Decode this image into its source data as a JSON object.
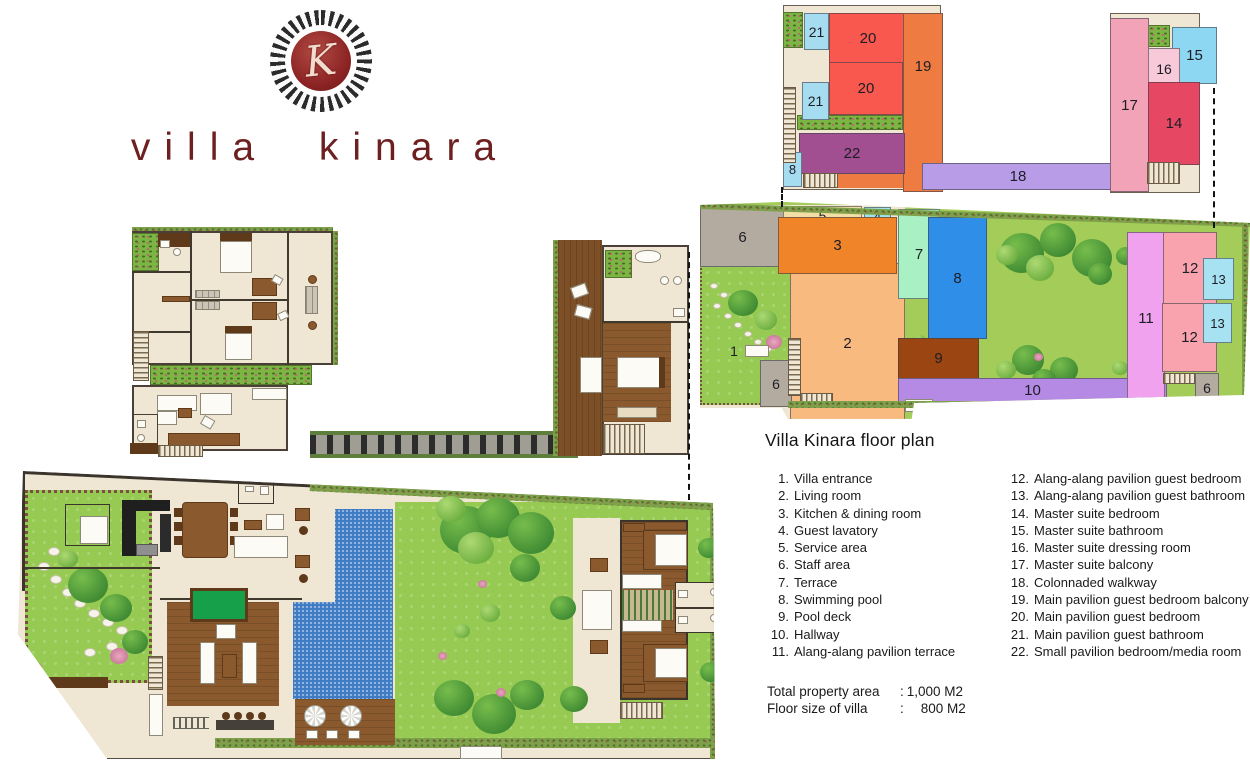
{
  "brand": {
    "wordmark": "villa kinara",
    "monogram": "K"
  },
  "panel": {
    "title": "Villa Kinara floor plan",
    "legend_left": [
      {
        "num": "1.",
        "label": "Villa entrance"
      },
      {
        "num": "2.",
        "label": "Living room"
      },
      {
        "num": "3.",
        "label": "Kitchen & dining room"
      },
      {
        "num": "4.",
        "label": "Guest lavatory"
      },
      {
        "num": "5.",
        "label": "Service area"
      },
      {
        "num": "6.",
        "label": "Staff area"
      },
      {
        "num": "7.",
        "label": "Terrace"
      },
      {
        "num": "8.",
        "label": "Swimming pool"
      },
      {
        "num": "9.",
        "label": "Pool deck"
      },
      {
        "num": "10.",
        "label": "Hallway"
      },
      {
        "num": "11.",
        "label": "Alang-alang pavilion terrace"
      }
    ],
    "legend_right": [
      {
        "num": "12.",
        "label": "Alang-alang pavilion guest bedroom"
      },
      {
        "num": "13.",
        "label": "Alang-alang pavilion guest bathroom"
      },
      {
        "num": "14.",
        "label": "Master suite bedroom"
      },
      {
        "num": "15.",
        "label": "Master suite bathroom"
      },
      {
        "num": "16.",
        "label": "Master suite dressing room"
      },
      {
        "num": "17.",
        "label": "Master suite balcony"
      },
      {
        "num": "18.",
        "label": "Colonnaded walkway"
      },
      {
        "num": "19.",
        "label": "Main pavilion guest bedroom balcony"
      },
      {
        "num": "20.",
        "label": "Main pavilion guest bedroom"
      },
      {
        "num": "21.",
        "label": "Main pavilion guest bathroom"
      },
      {
        "num": "22.",
        "label": "Small pavilion bedroom/media room"
      }
    ],
    "totals": [
      {
        "label": "Total property area",
        "sep": ":",
        "value": "1,000 M2"
      },
      {
        "label": "Floor size of villa",
        "sep": ":",
        "value": "800 M2"
      }
    ]
  },
  "colors": {
    "wordmark": "#6e2020",
    "room_number": "#1d1d26",
    "lawn_green": "#97ca52",
    "floor_beige": "#efe6d4",
    "pool_blue": "#3f7cc4",
    "wood_deck": "#8a5a2e"
  },
  "plans": {
    "upper_schematic": {
      "rooms": [
        {
          "id": "21a",
          "num": "21",
          "color": "#a6dcf0",
          "x": 21,
          "y": 8,
          "w": 23,
          "h": 35,
          "fs": 14
        },
        {
          "id": "20a",
          "num": "20",
          "color": "#f8584e",
          "x": 46,
          "y": 8,
          "w": 76,
          "h": 49
        },
        {
          "id": "20b",
          "num": "20",
          "color": "#f8584e",
          "x": 46,
          "y": 57,
          "w": 72,
          "h": 51
        },
        {
          "id": "19",
          "num": "19",
          "color": "#ee7b41",
          "x": 120,
          "y": 8,
          "w": 38,
          "h": 177,
          "lt": 45
        },
        {
          "id": "21b",
          "num": "21",
          "color": "#a6dcf0",
          "x": 19,
          "y": 77,
          "w": 25,
          "h": 36,
          "fs": 14
        },
        {
          "id": "22",
          "num": "22",
          "color": "#a14f90",
          "x": 16,
          "y": 128,
          "w": 104,
          "h": 39
        },
        {
          "id": "8u",
          "num": "8",
          "color": "#a6dcf0",
          "x": 0,
          "y": 147,
          "w": 17,
          "h": 33,
          "fs": 13
        },
        {
          "id": "18",
          "num": "18",
          "color": "#b89ce8",
          "x": 139,
          "y": 158,
          "w": 190,
          "h": 25
        },
        {
          "id": "17",
          "num": "17",
          "color": "#f2a3b8",
          "x": 327,
          "y": 13,
          "w": 37,
          "h": 172
        },
        {
          "id": "15",
          "num": "15",
          "color": "#8ed7f2",
          "x": 389,
          "y": 22,
          "w": 43,
          "h": 55
        },
        {
          "id": "16",
          "num": "16",
          "color": "#f7c9d9",
          "x": 365,
          "y": 43,
          "w": 30,
          "h": 39,
          "fs": 14
        },
        {
          "id": "14",
          "num": "14",
          "color": "#e64762",
          "x": 365,
          "y": 77,
          "w": 50,
          "h": 81
        }
      ]
    },
    "ground_schematic": {
      "rooms": [
        {
          "id": "6a",
          "num": "6",
          "color": "#b3aaa0",
          "x": 0,
          "y": 12,
          "w": 83,
          "h": 58
        },
        {
          "id": "5",
          "num": "5",
          "color": "#f2dfa7",
          "x": 83,
          "y": 11,
          "w": 77,
          "h": 18,
          "fs": 14
        },
        {
          "id": "4",
          "num": "4",
          "color": "#9fe3ee",
          "x": 164,
          "y": 12,
          "w": 25,
          "h": 16,
          "fs": 13
        },
        {
          "id": "2",
          "num": "2",
          "color": "#f9ba80",
          "x": 90,
          "y": 68,
          "w": 113,
          "h": 158
        },
        {
          "id": "3",
          "num": "3",
          "color": "#f08428",
          "x": 78,
          "y": 22,
          "w": 117,
          "h": 55
        },
        {
          "id": "7",
          "num": "7",
          "color": "#a9f0c4",
          "x": 198,
          "y": 14,
          "w": 40,
          "h": 88
        },
        {
          "id": "8g",
          "num": "8",
          "color": "#2f8fe8",
          "x": 228,
          "y": 22,
          "w": 57,
          "h": 120
        },
        {
          "id": "9",
          "num": "9",
          "color": "#9a4512",
          "x": 198,
          "y": 143,
          "w": 79,
          "h": 39
        },
        {
          "id": "10",
          "num": "10",
          "color": "#b48ae4",
          "x": 198,
          "y": 183,
          "w": 267,
          "h": 23
        },
        {
          "id": "11",
          "num": "11",
          "color": "#f0a2ee",
          "x": 427,
          "y": 37,
          "w": 36,
          "h": 170
        },
        {
          "id": "12a",
          "num": "12",
          "color": "#f8a3ad",
          "x": 463,
          "y": 37,
          "w": 52,
          "h": 71
        },
        {
          "id": "12b",
          "num": "12",
          "color": "#f8a3ad",
          "x": 462,
          "y": 108,
          "w": 53,
          "h": 67
        },
        {
          "id": "13a",
          "num": "13",
          "color": "#a6e2f2",
          "x": 503,
          "y": 63,
          "w": 29,
          "h": 40,
          "fs": 13
        },
        {
          "id": "13b",
          "num": "13",
          "color": "#a6e2f2",
          "x": 503,
          "y": 108,
          "w": 27,
          "h": 38,
          "fs": 13
        },
        {
          "id": "6b",
          "num": "6",
          "color": "#b3aaa0",
          "x": 60,
          "y": 165,
          "w": 30,
          "h": 45,
          "fs": 14
        },
        {
          "id": "6c",
          "num": "6",
          "color": "#b3aaa0",
          "x": 495,
          "y": 178,
          "w": 22,
          "h": 27,
          "fs": 14
        },
        {
          "id": "1",
          "num": "1",
          "color": "none",
          "x": 24,
          "y": 148,
          "w": 20,
          "h": 16,
          "fs": 14
        }
      ]
    }
  }
}
